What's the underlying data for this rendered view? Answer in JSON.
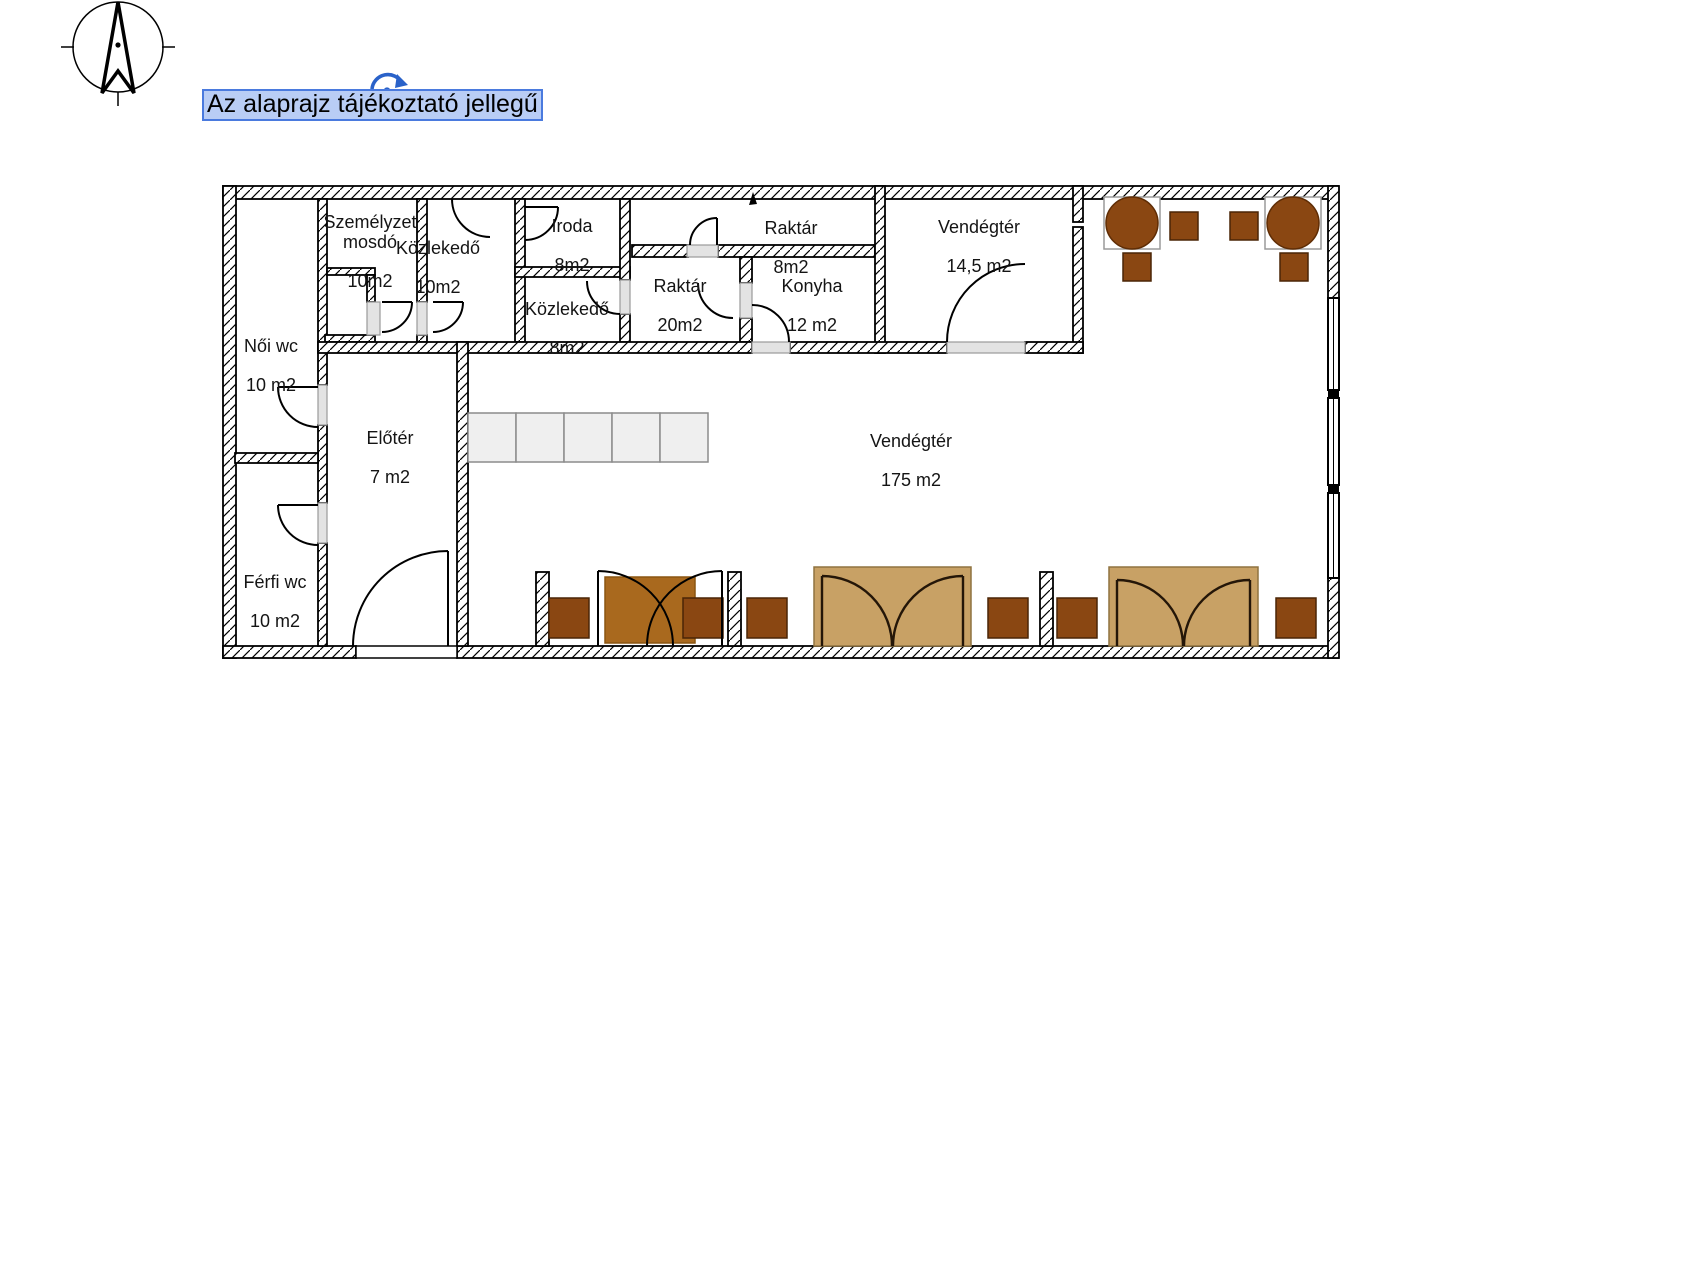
{
  "annotation": {
    "text": "Az alaprajz tájékoztató jellegű",
    "highlight_fill": "#b9cdf5",
    "highlight_border": "#4a7ade"
  },
  "rooms": [
    {
      "id": "szemelyzet-mosdo",
      "name": "Személyzet\nmosdó",
      "area": "10m2"
    },
    {
      "id": "kozlekedo-10",
      "name": "Közlekedő",
      "area": "10m2"
    },
    {
      "id": "iroda",
      "name": "Iroda",
      "area": "8m2"
    },
    {
      "id": "kozlekedo-8",
      "name": "Közlekedő",
      "area": "8m2"
    },
    {
      "id": "raktar-8",
      "name": "Raktár",
      "area": "8m2"
    },
    {
      "id": "raktar-20",
      "name": "Raktár",
      "area": "20m2"
    },
    {
      "id": "konyha",
      "name": "Konyha",
      "area": "12 m2"
    },
    {
      "id": "vendegter-14-5",
      "name": "Vendégtér",
      "area": "14,5 m2"
    },
    {
      "id": "noi-wc",
      "name": "Női wc",
      "area": "10 m2"
    },
    {
      "id": "eloter",
      "name": "Előtér",
      "area": "7 m2"
    },
    {
      "id": "ferfi-wc",
      "name": "Férfi wc",
      "area": "10 m2"
    },
    {
      "id": "vendegter-175",
      "name": "Vendégtér",
      "area": "175 m2"
    }
  ],
  "colors": {
    "chair": "#8a4712",
    "round_table": "#8a4712",
    "table": "#a9691e",
    "booth": "#c8a165",
    "counter": "#efefef",
    "rotate_icon": "#2a62c9",
    "wall_line": "#000000",
    "sill": "#e3e3e3"
  }
}
